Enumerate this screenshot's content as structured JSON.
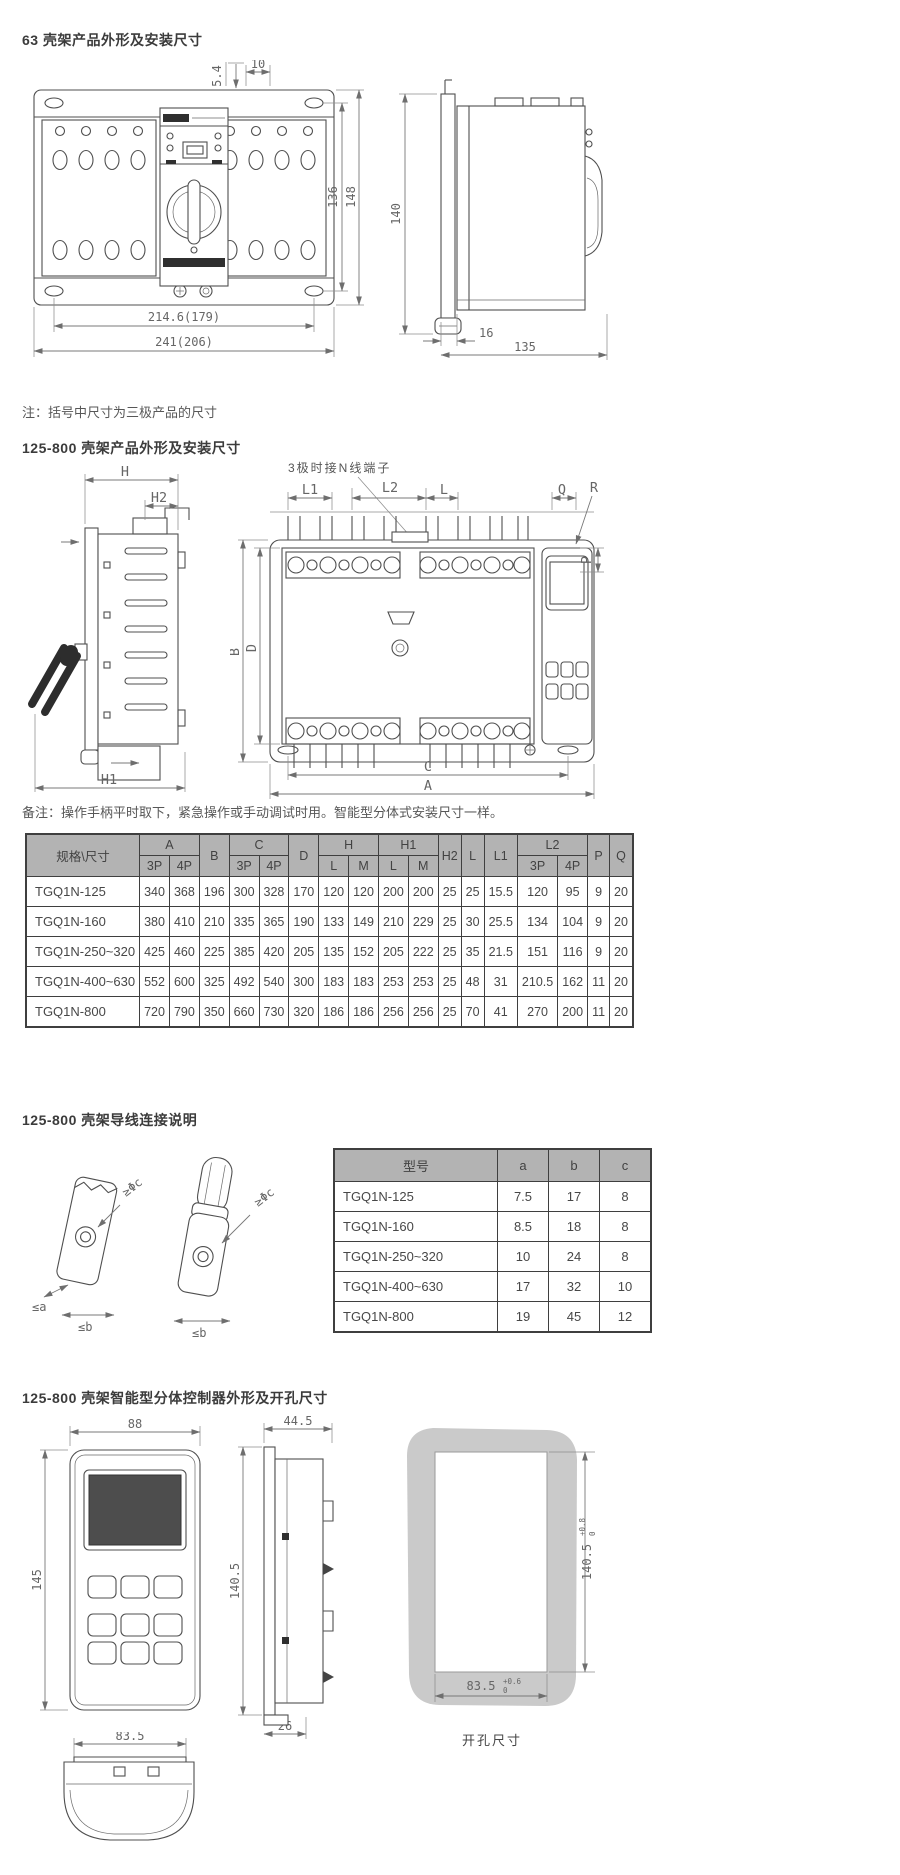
{
  "colors": {
    "header_gray": "#b3b3b3",
    "line": "#4f4f4f",
    "dim_text": "#666666",
    "screen": "#4d4d4d",
    "cutout_bg": "#cacaca"
  },
  "section1": {
    "title": "63 壳架产品外形及安装尺寸",
    "note": "注：括号中尺寸为三极产品的尺寸",
    "front_dims": {
      "slot": "5.4",
      "offset": "10",
      "inner_height": "136",
      "height": "148",
      "mount_width": "214.6(179)",
      "width": "241(206)"
    },
    "side_dims": {
      "height": "140",
      "bracket": "16",
      "depth": "135"
    }
  },
  "section2": {
    "title": "125-800 壳架产品外形及安装尺寸",
    "annotation": "3极时接N线端子",
    "remark": "备注：操作手柄平时取下，紧急操作或手动调试时用。智能型分体式安装尺寸一样。",
    "side_dims": {
      "h": "H",
      "h1": "H1",
      "h2": "H2"
    },
    "front_dims": {
      "l1": "L1",
      "l2": "L2",
      "l": "L",
      "q": "Q",
      "r": "R",
      "p": "P",
      "b": "B",
      "d": "D",
      "c": "C",
      "a": "A"
    },
    "table": {
      "corner": "规格\\尺寸",
      "h1": [
        "A",
        "B",
        "C",
        "D",
        "H",
        "H1",
        "H2",
        "L",
        "L1",
        "L2",
        "P",
        "Q"
      ],
      "sub": {
        "a3p": "3P",
        "a4p": "4P",
        "c3p": "3P",
        "c4p": "4P",
        "hl": "L",
        "hm": "M",
        "h1l": "L",
        "h1m": "M",
        "l23p": "3P",
        "l24p": "4P"
      },
      "rows": [
        [
          "TGQ1N-125",
          "340",
          "368",
          "196",
          "300",
          "328",
          "170",
          "120",
          "120",
          "200",
          "200",
          "25",
          "25",
          "15.5",
          "120",
          "95",
          "9",
          "20"
        ],
        [
          "TGQ1N-160",
          "380",
          "410",
          "210",
          "335",
          "365",
          "190",
          "133",
          "149",
          "210",
          "229",
          "25",
          "30",
          "25.5",
          "134",
          "104",
          "9",
          "20"
        ],
        [
          "TGQ1N-250~320",
          "425",
          "460",
          "225",
          "385",
          "420",
          "205",
          "135",
          "152",
          "205",
          "222",
          "25",
          "35",
          "21.5",
          "151",
          "116",
          "9",
          "20"
        ],
        [
          "TGQ1N-400~630",
          "552",
          "600",
          "325",
          "492",
          "540",
          "300",
          "183",
          "183",
          "253",
          "253",
          "25",
          "48",
          "31",
          "210.5",
          "162",
          "11",
          "20"
        ],
        [
          "TGQ1N-800",
          "720",
          "790",
          "350",
          "660",
          "730",
          "320",
          "186",
          "186",
          "256",
          "256",
          "25",
          "70",
          "41",
          "270",
          "200",
          "11",
          "20"
        ]
      ]
    }
  },
  "section3": {
    "title": "125-800 壳架导线连接说明",
    "lug_labels": {
      "phi": "≥Φc",
      "a": "≤a",
      "b": "≤b"
    },
    "table": {
      "headers": [
        "型号",
        "a",
        "b",
        "c"
      ],
      "rows": [
        [
          "TGQ1N-125",
          "7.5",
          "17",
          "8"
        ],
        [
          "TGQ1N-160",
          "8.5",
          "18",
          "8"
        ],
        [
          "TGQ1N-250~320",
          "10",
          "24",
          "8"
        ],
        [
          "TGQ1N-400~630",
          "17",
          "32",
          "10"
        ],
        [
          "TGQ1N-800",
          "19",
          "45",
          "12"
        ]
      ]
    }
  },
  "section4": {
    "title": "125-800 壳架智能型分体控制器外形及开孔尺寸",
    "front_dims": {
      "width": "88",
      "height": "145"
    },
    "side_dims": {
      "width": "44.5",
      "height": "140.5",
      "base": "26"
    },
    "cutout": {
      "height": "140.5",
      "height_tol_upper": "+0.8",
      "height_tol_lower": "0",
      "width": "83.5",
      "width_tol_upper": "+0.6",
      "width_tol_lower": "0",
      "caption": "开孔尺寸"
    },
    "handle_dims": {
      "width": "83.5"
    }
  }
}
